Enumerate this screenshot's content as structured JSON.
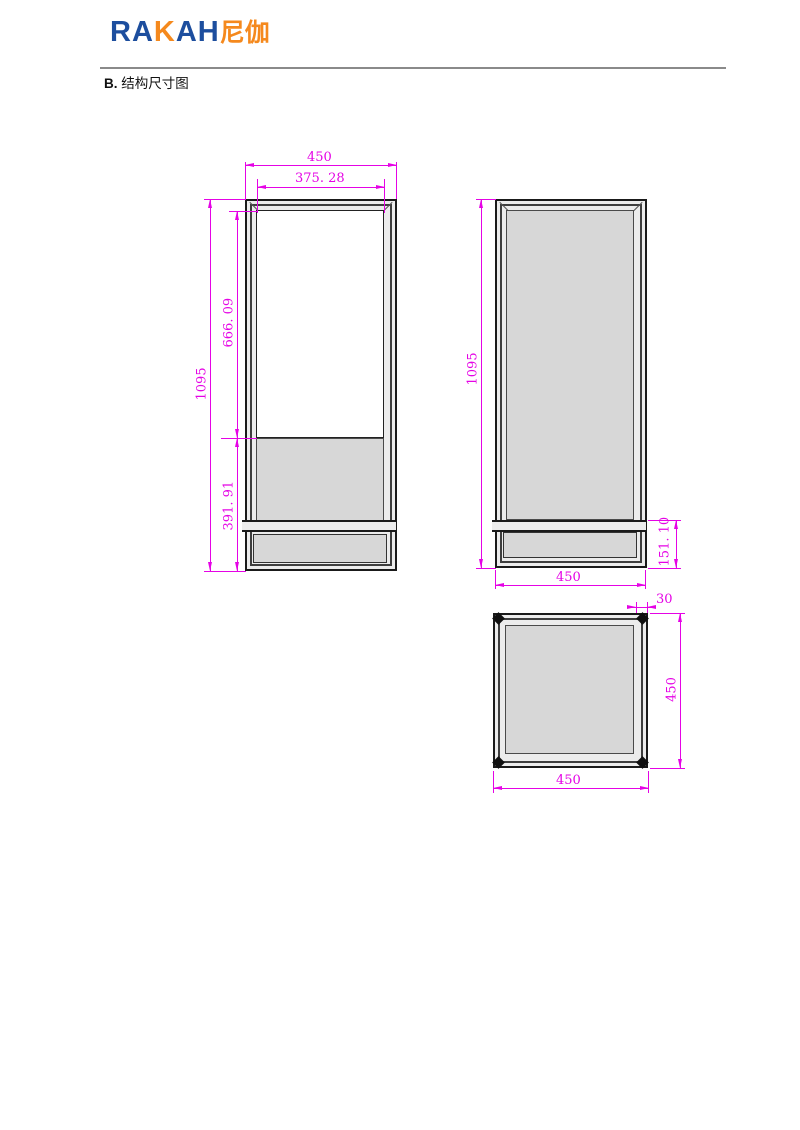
{
  "header": {
    "logo": {
      "blue_left": "RA",
      "orange_k": "K",
      "blue_right": "AH",
      "cn_suffix": "尼伽"
    },
    "section_label": "B.",
    "section_title": "结构尺寸图"
  },
  "colors": {
    "dim": "#e503e5",
    "logo_blue": "#1d4e9e",
    "logo_orange": "#f5891d",
    "line_dark": "#1a1a1a",
    "panel_gray": "#d7d7d7",
    "frame_gray": "#ececec"
  },
  "drawing": {
    "front_view": {
      "width": "450",
      "inner_width": "375. 28",
      "height": "1095",
      "screen_height": "666. 09",
      "lower_height": "391. 91"
    },
    "back_view": {
      "height": "1095",
      "base_height": "151. 10",
      "width": "450"
    },
    "top_view": {
      "frame_offset": "30",
      "depth": "450",
      "width": "450"
    }
  }
}
